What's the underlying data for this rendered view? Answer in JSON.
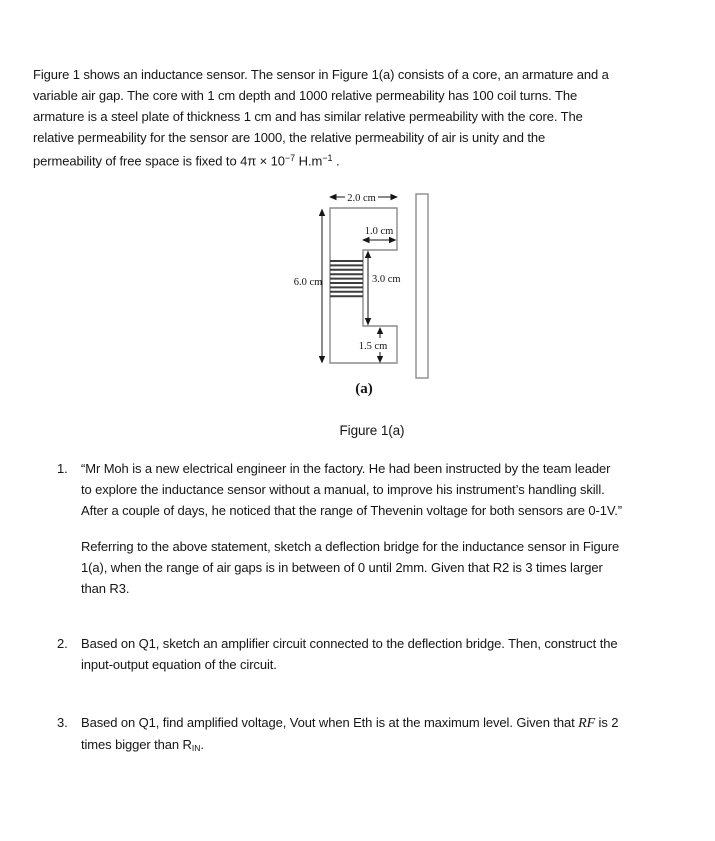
{
  "intro": {
    "lines": [
      "Figure 1 shows an inductance sensor. The sensor in Figure 1(a) consists of a core, an armature and a",
      "variable air gap. The core with 1 cm depth and 1000 relative permeability has 100 coil turns. The",
      "armature is a steel plate of thickness 1 cm and has similar relative permeability with the core. The",
      "relative permeability for the sensor are 1000, the relative permeability of air is unity and the"
    ],
    "last_line": {
      "pre": "permeability of free space is fixed to 4π × 10",
      "sup1": "−7",
      "mid": " H.m",
      "sup2": "−1",
      "end": " ."
    }
  },
  "figure": {
    "dims": {
      "core_width": "2.0 cm",
      "notch_width": "1.0 cm",
      "core_height": "6.0 cm",
      "notch_height": "3.0 cm",
      "bottom_height": "1.5 cm"
    },
    "sub_caption": "(a)",
    "caption": "Figure 1(a)",
    "outline_color": "#8c8c8c",
    "coil_color": "#3d3d3d",
    "annotation_color": "#161616"
  },
  "questions": {
    "q1": {
      "number": "1.",
      "quote_lines": [
        "“Mr Moh is a new electrical engineer in the factory. He had been instructed by the team leader",
        "to explore the inductance sensor without a manual, to improve his instrument’s handling skill.",
        "After a couple of days, he noticed that the range of Thevenin voltage for both sensors are 0-1V.”"
      ],
      "task_lines": [
        "Referring to the above statement, sketch a deflection bridge for the inductance sensor in Figure",
        "1(a), when the range of air gaps is in between of 0 until 2mm. Given that R2 is 3 times larger",
        "than R3."
      ]
    },
    "q2": {
      "number": "2.",
      "lines": [
        "Based on Q1, sketch an amplifier circuit connected to the deflection bridge. Then, construct the",
        "input-output equation of the circuit."
      ]
    },
    "q3": {
      "number": "3.",
      "line1_pre": "Based on Q1, find amplified voltage, Vout when Eth is at the maximum level. Given that ",
      "line1_rf": "RF",
      "line1_post": " is 2",
      "line2_pre": "times bigger than R",
      "line2_sub": "IN",
      "line2_post": "."
    }
  }
}
